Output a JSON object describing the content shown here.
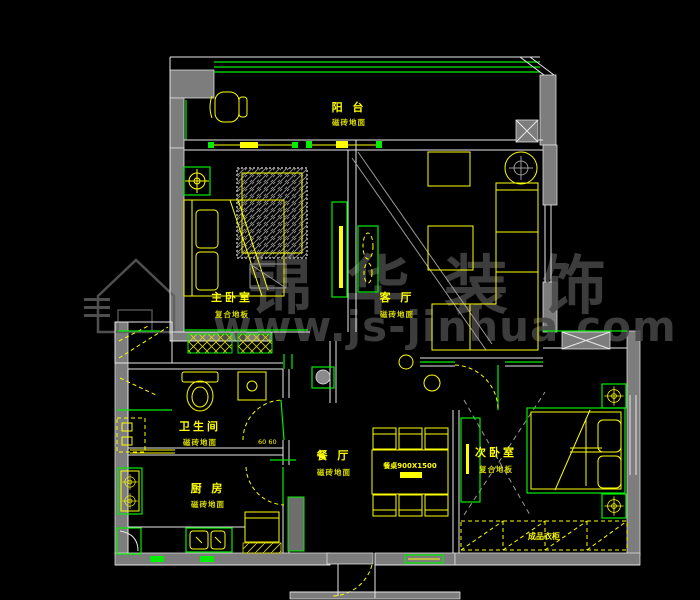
{
  "document": {
    "type": "floor-plan-cad-drawing",
    "background": "#000000"
  },
  "colors": {
    "wall_fill": "#7d7d7d",
    "structure_line": "#ffffff",
    "fixture_green": "#00ee00",
    "furniture_yellow": "#ffff00",
    "watermark_gray": "#474747"
  },
  "rooms": [
    {
      "id": "balcony",
      "name": "阳 台",
      "floor": "磁砖地面"
    },
    {
      "id": "master-bedroom",
      "name": "主卧室",
      "floor": "复合地板"
    },
    {
      "id": "living-room",
      "name": "客 厅",
      "floor": "磁砖地面"
    },
    {
      "id": "bathroom",
      "name": "卫生间",
      "floor": "磁砖地面"
    },
    {
      "id": "kitchen",
      "name": "厨 房",
      "floor": "磁砖地面"
    },
    {
      "id": "dining-room",
      "name": "餐 厅",
      "floor": "磁砖地面"
    },
    {
      "id": "second-bedroom",
      "name": "次卧室",
      "floor": "复合地板"
    }
  ],
  "annotations": {
    "dining_table_size": "餐桌900X1500",
    "wardrobe_label": "成品衣柜",
    "door_dimension": "60 60"
  },
  "watermark": {
    "brand": "锦华装饰",
    "url": "www.js-jinhua.com"
  }
}
